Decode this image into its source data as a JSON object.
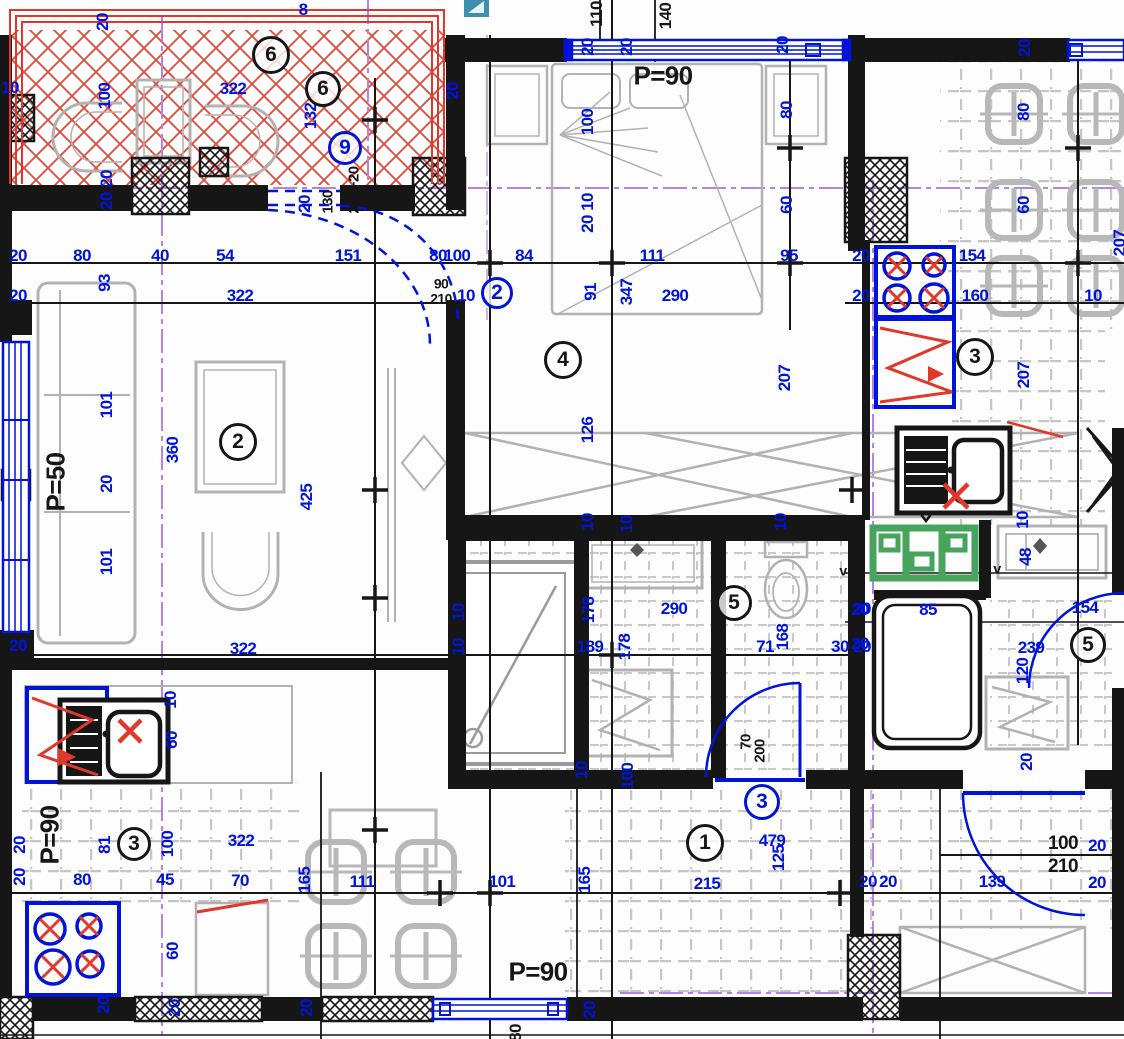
{
  "drawing": {
    "type": "apartment-floor-plan",
    "colors": {
      "dimension_blue": "#0013d8",
      "wall_black": "#161616",
      "fixture_red": "#e0382a",
      "sanitary_green": "#46a45d",
      "axis_purple": "#b483e4",
      "furniture_gray": "#b2b2b2",
      "tile_gray": "#c6c6c6",
      "overlay_teal": "#3e8fae"
    },
    "area_texts": [
      "P=90",
      "P=50",
      "P=90",
      "P=90"
    ],
    "room_circles": [
      {
        "n": "6",
        "x": 271,
        "y": 55,
        "c": "k",
        "d": 38
      },
      {
        "n": "6",
        "x": 323,
        "y": 89,
        "c": "k",
        "d": 36
      },
      {
        "n": "9",
        "x": 345,
        "y": 148,
        "c": "b",
        "d": 34
      },
      {
        "n": "2",
        "x": 497,
        "y": 293,
        "c": "b",
        "d": 32
      },
      {
        "n": "2",
        "x": 238,
        "y": 442,
        "c": "k",
        "d": 38
      },
      {
        "n": "4",
        "x": 563,
        "y": 360,
        "c": "k",
        "d": 38
      },
      {
        "n": "3",
        "x": 975,
        "y": 357,
        "c": "k",
        "d": 38
      },
      {
        "n": "5",
        "x": 734,
        "y": 603,
        "c": "k",
        "d": 36
      },
      {
        "n": "5",
        "x": 1088,
        "y": 645,
        "c": "k",
        "d": 36
      },
      {
        "n": "3",
        "x": 134,
        "y": 844,
        "c": "k",
        "d": 34
      },
      {
        "n": "1",
        "x": 705,
        "y": 843,
        "c": "k",
        "d": 38
      },
      {
        "n": "3",
        "x": 762,
        "y": 802,
        "c": "b",
        "d": 36
      }
    ],
    "plan_labels": [
      {
        "t": "20",
        "x": 103,
        "y": 22,
        "r": 1
      },
      {
        "t": "8",
        "x": 303,
        "y": 11
      },
      {
        "t": "322",
        "x": 233,
        "y": 90
      },
      {
        "t": "100",
        "x": 105,
        "y": 96,
        "r": 1
      },
      {
        "t": "132",
        "x": 311,
        "y": 116,
        "r": 1
      },
      {
        "t": "20",
        "x": 453,
        "y": 91,
        "r": 1
      },
      {
        "t": "10",
        "x": 10,
        "y": 89
      },
      {
        "t": "20",
        "x": 107,
        "y": 179,
        "r": 1
      },
      {
        "t": "20",
        "x": 107,
        "y": 201,
        "r": 1
      },
      {
        "t": "20",
        "x": 305,
        "y": 204,
        "r": 1
      },
      {
        "t": "130",
        "x": 328,
        "y": 202,
        "r": 1,
        "c": "k",
        "fs": 15
      },
      {
        "t": "220+20",
        "x": 354,
        "y": 190,
        "r": 1,
        "c": "k",
        "fs": 15
      },
      {
        "t": "20",
        "x": 18,
        "y": 257
      },
      {
        "t": "80",
        "x": 82,
        "y": 257
      },
      {
        "t": "40",
        "x": 160,
        "y": 257
      },
      {
        "t": "54",
        "x": 225,
        "y": 257
      },
      {
        "t": "151",
        "x": 348,
        "y": 257
      },
      {
        "t": "80",
        "x": 438,
        "y": 257
      },
      {
        "t": "100",
        "x": 457,
        "y": 257
      },
      {
        "t": "84",
        "x": 524,
        "y": 257
      },
      {
        "t": "111",
        "x": 652,
        "y": 257
      },
      {
        "t": "95",
        "x": 789,
        "y": 257
      },
      {
        "t": "20",
        "x": 861,
        "y": 257
      },
      {
        "t": "154",
        "x": 972,
        "y": 257
      },
      {
        "t": "20",
        "x": 18,
        "y": 297
      },
      {
        "t": "93",
        "x": 105,
        "y": 283,
        "r": 1
      },
      {
        "t": "322",
        "x": 240,
        "y": 297
      },
      {
        "t": "90",
        "x": 441,
        "y": 284,
        "c": "k",
        "fs": 14
      },
      {
        "t": "210",
        "x": 441,
        "y": 299,
        "c": "k",
        "fs": 14
      },
      {
        "t": "10",
        "x": 466,
        "y": 297
      },
      {
        "t": "91",
        "x": 591,
        "y": 292,
        "r": 1
      },
      {
        "t": "347",
        "x": 627,
        "y": 292,
        "r": 1
      },
      {
        "t": "290",
        "x": 675,
        "y": 297
      },
      {
        "t": "20",
        "x": 861,
        "y": 297
      },
      {
        "t": "160",
        "x": 975,
        "y": 297
      },
      {
        "t": "10",
        "x": 1093,
        "y": 297
      },
      {
        "t": "110",
        "x": 597,
        "y": 14,
        "r": 1,
        "c": "k"
      },
      {
        "t": "140",
        "x": 666,
        "y": 16,
        "r": 1,
        "c": "k"
      },
      {
        "t": "20",
        "x": 588,
        "y": 47,
        "r": 1
      },
      {
        "t": "20",
        "x": 627,
        "y": 47,
        "r": 1
      },
      {
        "t": "P=90",
        "x": 663,
        "y": 77,
        "c": "k",
        "fs": 26
      },
      {
        "t": "20",
        "x": 783,
        "y": 45,
        "r": 1
      },
      {
        "t": "100",
        "x": 588,
        "y": 122,
        "r": 1
      },
      {
        "t": "80",
        "x": 787,
        "y": 110,
        "r": 1
      },
      {
        "t": "10",
        "x": 588,
        "y": 202,
        "r": 1
      },
      {
        "t": "20",
        "x": 588,
        "y": 224,
        "r": 1
      },
      {
        "t": "60",
        "x": 787,
        "y": 205,
        "r": 1
      },
      {
        "t": "20",
        "x": 1025,
        "y": 48,
        "r": 1
      },
      {
        "t": "80",
        "x": 1024,
        "y": 112,
        "r": 1
      },
      {
        "t": "60",
        "x": 1024,
        "y": 205,
        "r": 1
      },
      {
        "t": "207",
        "x": 1120,
        "y": 243,
        "r": 1
      },
      {
        "t": "126",
        "x": 588,
        "y": 430,
        "r": 1
      },
      {
        "t": "207",
        "x": 785,
        "y": 378,
        "r": 1
      },
      {
        "t": "10",
        "x": 588,
        "y": 522,
        "r": 1
      },
      {
        "t": "10",
        "x": 627,
        "y": 524,
        "r": 1
      },
      {
        "t": "10",
        "x": 781,
        "y": 522,
        "r": 1
      },
      {
        "t": "207",
        "x": 1024,
        "y": 375,
        "r": 1
      },
      {
        "t": "101",
        "x": 107,
        "y": 405,
        "r": 1
      },
      {
        "t": "360",
        "x": 173,
        "y": 450,
        "r": 1
      },
      {
        "t": "20",
        "x": 107,
        "y": 484,
        "r": 1
      },
      {
        "t": "101",
        "x": 107,
        "y": 562,
        "r": 1
      },
      {
        "t": "425",
        "x": 307,
        "y": 497,
        "r": 1
      },
      {
        "t": "P=50",
        "x": 56,
        "y": 482,
        "r": 1,
        "c": "k",
        "fs": 26
      },
      {
        "t": "20",
        "x": 18,
        "y": 647
      },
      {
        "t": "322",
        "x": 243,
        "y": 650
      },
      {
        "t": "10",
        "x": 459,
        "y": 612,
        "r": 1
      },
      {
        "t": "10",
        "x": 459,
        "y": 647,
        "r": 1
      },
      {
        "t": "178",
        "x": 589,
        "y": 610,
        "r": 1
      },
      {
        "t": "290",
        "x": 674,
        "y": 610
      },
      {
        "t": "189",
        "x": 590,
        "y": 648
      },
      {
        "t": "178",
        "x": 625,
        "y": 647,
        "r": 1
      },
      {
        "t": "71",
        "x": 765,
        "y": 648
      },
      {
        "t": "168",
        "x": 783,
        "y": 637,
        "r": 1
      },
      {
        "t": "30",
        "x": 840,
        "y": 648
      },
      {
        "t": "20",
        "x": 862,
        "y": 610
      },
      {
        "t": "20",
        "x": 862,
        "y": 648
      },
      {
        "t": "70",
        "x": 746,
        "y": 742,
        "r": 1,
        "c": "k",
        "fs": 15
      },
      {
        "t": "200",
        "x": 760,
        "y": 751,
        "r": 1,
        "c": "k",
        "fs": 15
      },
      {
        "t": "10",
        "x": 582,
        "y": 770,
        "r": 1
      },
      {
        "t": "100",
        "x": 628,
        "y": 776,
        "r": 1
      },
      {
        "t": "10",
        "x": 1023,
        "y": 520,
        "r": 1
      },
      {
        "t": "48",
        "x": 1026,
        "y": 557,
        "r": 1
      },
      {
        "t": "v",
        "x": 843,
        "y": 571,
        "c": "k",
        "fs": 14
      },
      {
        "t": "v",
        "x": 997,
        "y": 569,
        "c": "k",
        "fs": 14
      },
      {
        "t": "154",
        "x": 1085,
        "y": 609
      },
      {
        "t": "20",
        "x": 860,
        "y": 611
      },
      {
        "t": "85",
        "x": 928,
        "y": 611
      },
      {
        "t": "20",
        "x": 860,
        "y": 645
      },
      {
        "t": "239",
        "x": 1031,
        "y": 649
      },
      {
        "t": "120",
        "x": 1023,
        "y": 671,
        "r": 1
      },
      {
        "t": "20",
        "x": 1027,
        "y": 762,
        "r": 1
      },
      {
        "t": "10",
        "x": 171,
        "y": 700,
        "r": 1
      },
      {
        "t": "60",
        "x": 172,
        "y": 740,
        "r": 1
      },
      {
        "t": "P=90",
        "x": 50,
        "y": 835,
        "r": 1,
        "c": "k",
        "fs": 26
      },
      {
        "t": "81",
        "x": 105,
        "y": 845,
        "r": 1
      },
      {
        "t": "100",
        "x": 168,
        "y": 844,
        "r": 1
      },
      {
        "t": "322",
        "x": 241,
        "y": 842
      },
      {
        "t": "20",
        "x": 20,
        "y": 845,
        "r": 1
      },
      {
        "t": "20",
        "x": 20,
        "y": 877,
        "r": 1
      },
      {
        "t": "80",
        "x": 82,
        "y": 881
      },
      {
        "t": "45",
        "x": 165,
        "y": 881
      },
      {
        "t": "70",
        "x": 240,
        "y": 882
      },
      {
        "t": "60",
        "x": 173,
        "y": 951,
        "r": 1
      },
      {
        "t": "20",
        "x": 104,
        "y": 1005,
        "r": 1
      },
      {
        "t": "20",
        "x": 175,
        "y": 1008,
        "r": 1
      },
      {
        "t": "20",
        "x": 307,
        "y": 1008,
        "r": 1
      },
      {
        "t": "165",
        "x": 305,
        "y": 880,
        "r": 1
      },
      {
        "t": "111",
        "x": 362,
        "y": 883
      },
      {
        "t": "101",
        "x": 502,
        "y": 883
      },
      {
        "t": "165",
        "x": 585,
        "y": 880,
        "r": 1
      },
      {
        "t": "215",
        "x": 707,
        "y": 885
      },
      {
        "t": "479",
        "x": 772,
        "y": 842
      },
      {
        "t": "125",
        "x": 779,
        "y": 858,
        "r": 1
      },
      {
        "t": "20",
        "x": 868,
        "y": 883
      },
      {
        "t": "20",
        "x": 888,
        "y": 883
      },
      {
        "t": "139",
        "x": 992,
        "y": 883
      },
      {
        "t": "100",
        "x": 1063,
        "y": 845,
        "c": "k",
        "fs": 19
      },
      {
        "t": "210",
        "x": 1063,
        "y": 868,
        "c": "k",
        "fs": 19
      },
      {
        "t": "20",
        "x": 1097,
        "y": 847
      },
      {
        "t": "20",
        "x": 1097,
        "y": 884
      },
      {
        "t": "P=90",
        "x": 538,
        "y": 973,
        "c": "k",
        "fs": 26
      },
      {
        "t": "20",
        "x": 590,
        "y": 1010,
        "r": 1
      },
      {
        "t": "80",
        "x": 516,
        "y": 1033,
        "r": 1,
        "c": "k"
      }
    ]
  }
}
